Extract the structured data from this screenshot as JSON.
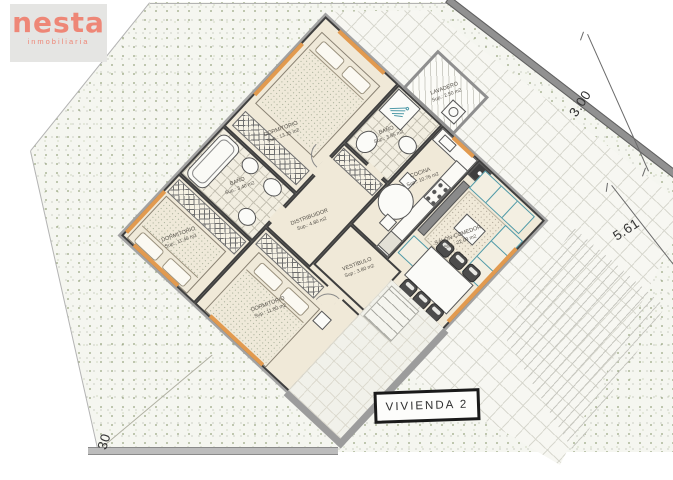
{
  "logo": {
    "brand": "nesta",
    "subtitle": "inmobiliaria"
  },
  "plan": {
    "title": "VIVIENDA 2",
    "rooms": [
      {
        "id": "dormitorio-1",
        "label": "DORMITORIO",
        "area": "Sup.: 13.25 m2"
      },
      {
        "id": "bano-2",
        "label": "BAÑO",
        "area": "Sup.: 3.85 m2"
      },
      {
        "id": "lavadero",
        "label": "LAVADERO",
        "area": "Sup.: 2.50 m2"
      },
      {
        "id": "cocina",
        "label": "COCINA",
        "area": "Sup.: 10.76 m2"
      },
      {
        "id": "salon",
        "label": "SALÓN-COMEDOR",
        "area": "Sup.: 22.09 m2"
      },
      {
        "id": "distribuidor",
        "label": "DISTRIBUIDOR",
        "area": "Sup.: 4.80 m2"
      },
      {
        "id": "bano-1",
        "label": "BAÑO",
        "area": "Sup.: 3.40 m2"
      },
      {
        "id": "vestibulo",
        "label": "VESTÍBULO",
        "area": "Sup.: 3.80 m2"
      },
      {
        "id": "dormitorio-2",
        "label": "DORMITORIO",
        "area": "Sup.: 11.40 m2"
      },
      {
        "id": "dormitorio-3",
        "label": "DORMITORIO",
        "area": "Sup.: 11.80 m2"
      }
    ],
    "dimensions": [
      {
        "value": "3.00"
      },
      {
        "value": "5.61"
      },
      {
        "value": "30"
      }
    ]
  },
  "colors": {
    "brand_coral": "#ee8777",
    "wall_dark": "#474747",
    "wall_light": "#9c9c9c",
    "floor_cream": "#f0e9d8",
    "furniture_teal": "#4f9aa8",
    "window_orange": "#e29a4f",
    "grass_speckle": "#8e9c74"
  }
}
